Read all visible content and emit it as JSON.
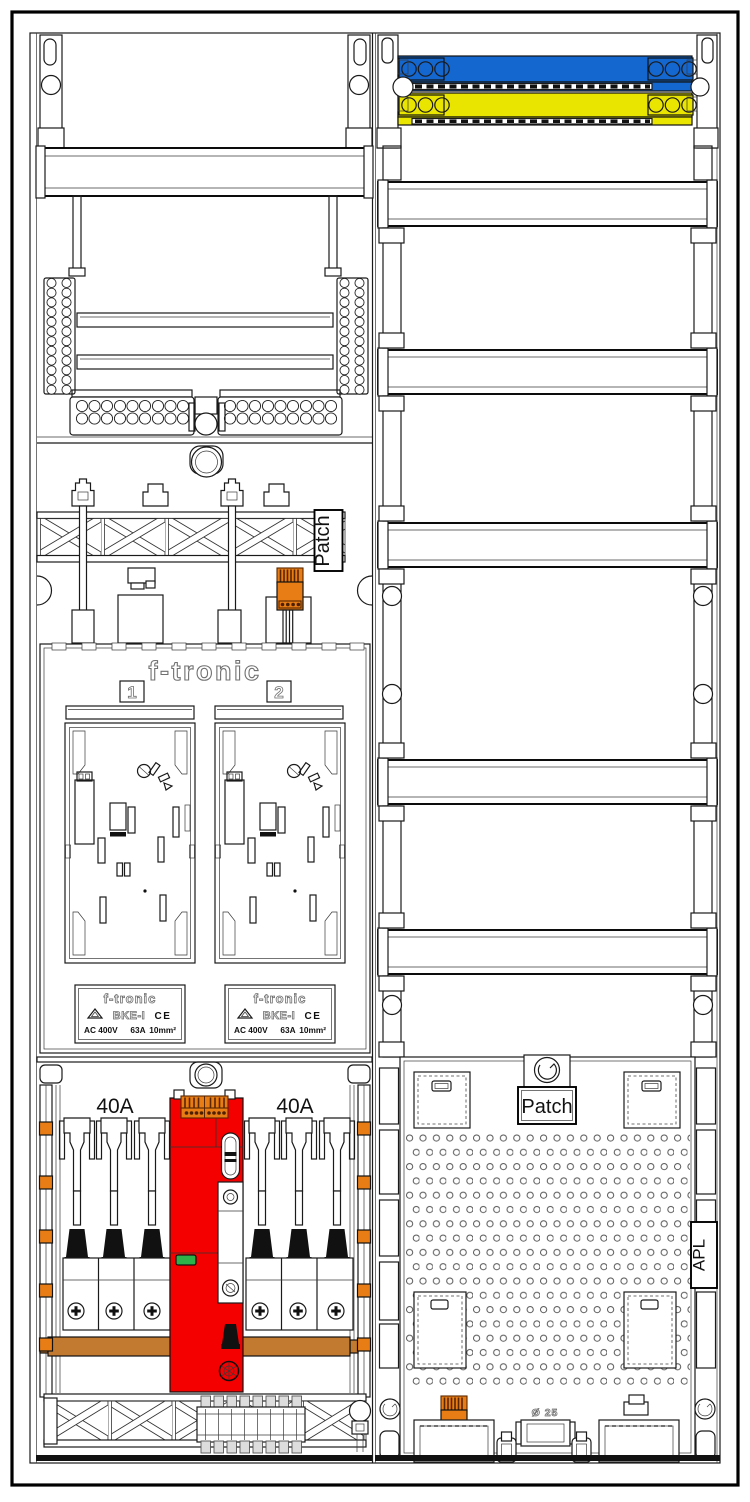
{
  "labels": {
    "patch_left": "Patch",
    "patch_right": "Patch",
    "brand": "f-tronic",
    "meter_field_1": "1",
    "meter_field_2": "2",
    "bke": {
      "brand": "f-tronic",
      "model": "BKE-I",
      "ce": "CE",
      "voltage": "AC 400V",
      "current": "63A",
      "wire": "10mm²"
    },
    "rating_left": "40A",
    "rating_right": "40A",
    "apl": "APL",
    "conduit": "Ø 25"
  },
  "colors": {
    "busbar_blue": "#1467cf",
    "busbar_yellow": "#e9e500",
    "terminal_orange": "#e87d15",
    "sls_red": "#f40000",
    "copper": "#c17a30",
    "indicator_green": "#2db24a"
  }
}
